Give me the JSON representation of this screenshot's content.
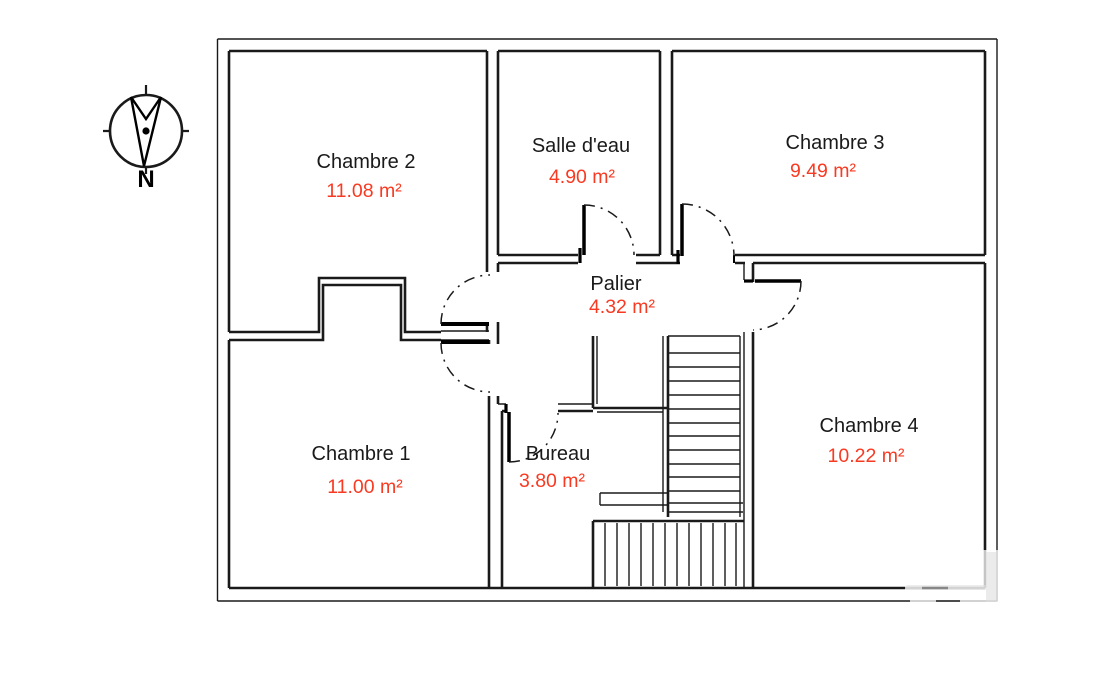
{
  "plan": {
    "type": "floor-plan",
    "compass": {
      "north_label": "N"
    },
    "rooms": [
      {
        "id": "chambre-2",
        "name": "Chambre 2",
        "area": "11.08 m²"
      },
      {
        "id": "salle-deau",
        "name": "Salle d'eau",
        "area": "4.90 m²"
      },
      {
        "id": "chambre-3",
        "name": "Chambre 3",
        "area": "9.49 m²"
      },
      {
        "id": "palier",
        "name": "Palier",
        "area": "4.32 m²"
      },
      {
        "id": "chambre-1",
        "name": "Chambre 1",
        "area": "11.00 m²"
      },
      {
        "id": "bureau",
        "name": "Bureau",
        "area": "3.80 m²"
      },
      {
        "id": "chambre-4",
        "name": "Chambre 4",
        "area": "10.22 m²"
      }
    ],
    "colors": {
      "wall": "#1a1a1a",
      "room_name_text": "#1a1a1a",
      "room_area_text": "#f93a22"
    }
  }
}
